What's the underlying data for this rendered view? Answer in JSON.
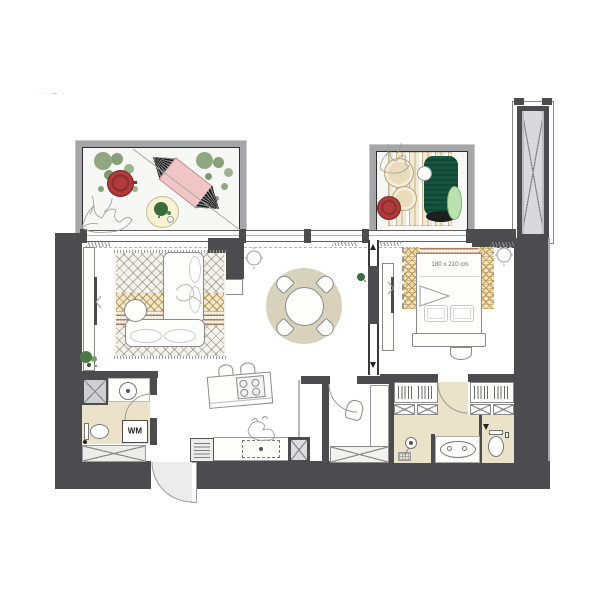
{
  "labels": {
    "bed_size": "180 x 210 cm",
    "washing_machine": "WM",
    "corner_marks": "· ·· — ·"
  },
  "colors": {
    "wall_dark": "#4c4c4f",
    "balcony_wall": "#a6a6a8",
    "floor_beige": "#ebe3c9",
    "rug_beige": "#d8d1bb",
    "hammock_pink": "#f0c5c5",
    "accent_red": "#b13c3d",
    "lounge_green": "#175440",
    "cushion_green": "#b9e2ae",
    "plant_green": "#8fa881",
    "pouf_cream": "#eadcba",
    "gold_pattern": "#c09a4a",
    "line_gray": "#8a8a8c"
  }
}
